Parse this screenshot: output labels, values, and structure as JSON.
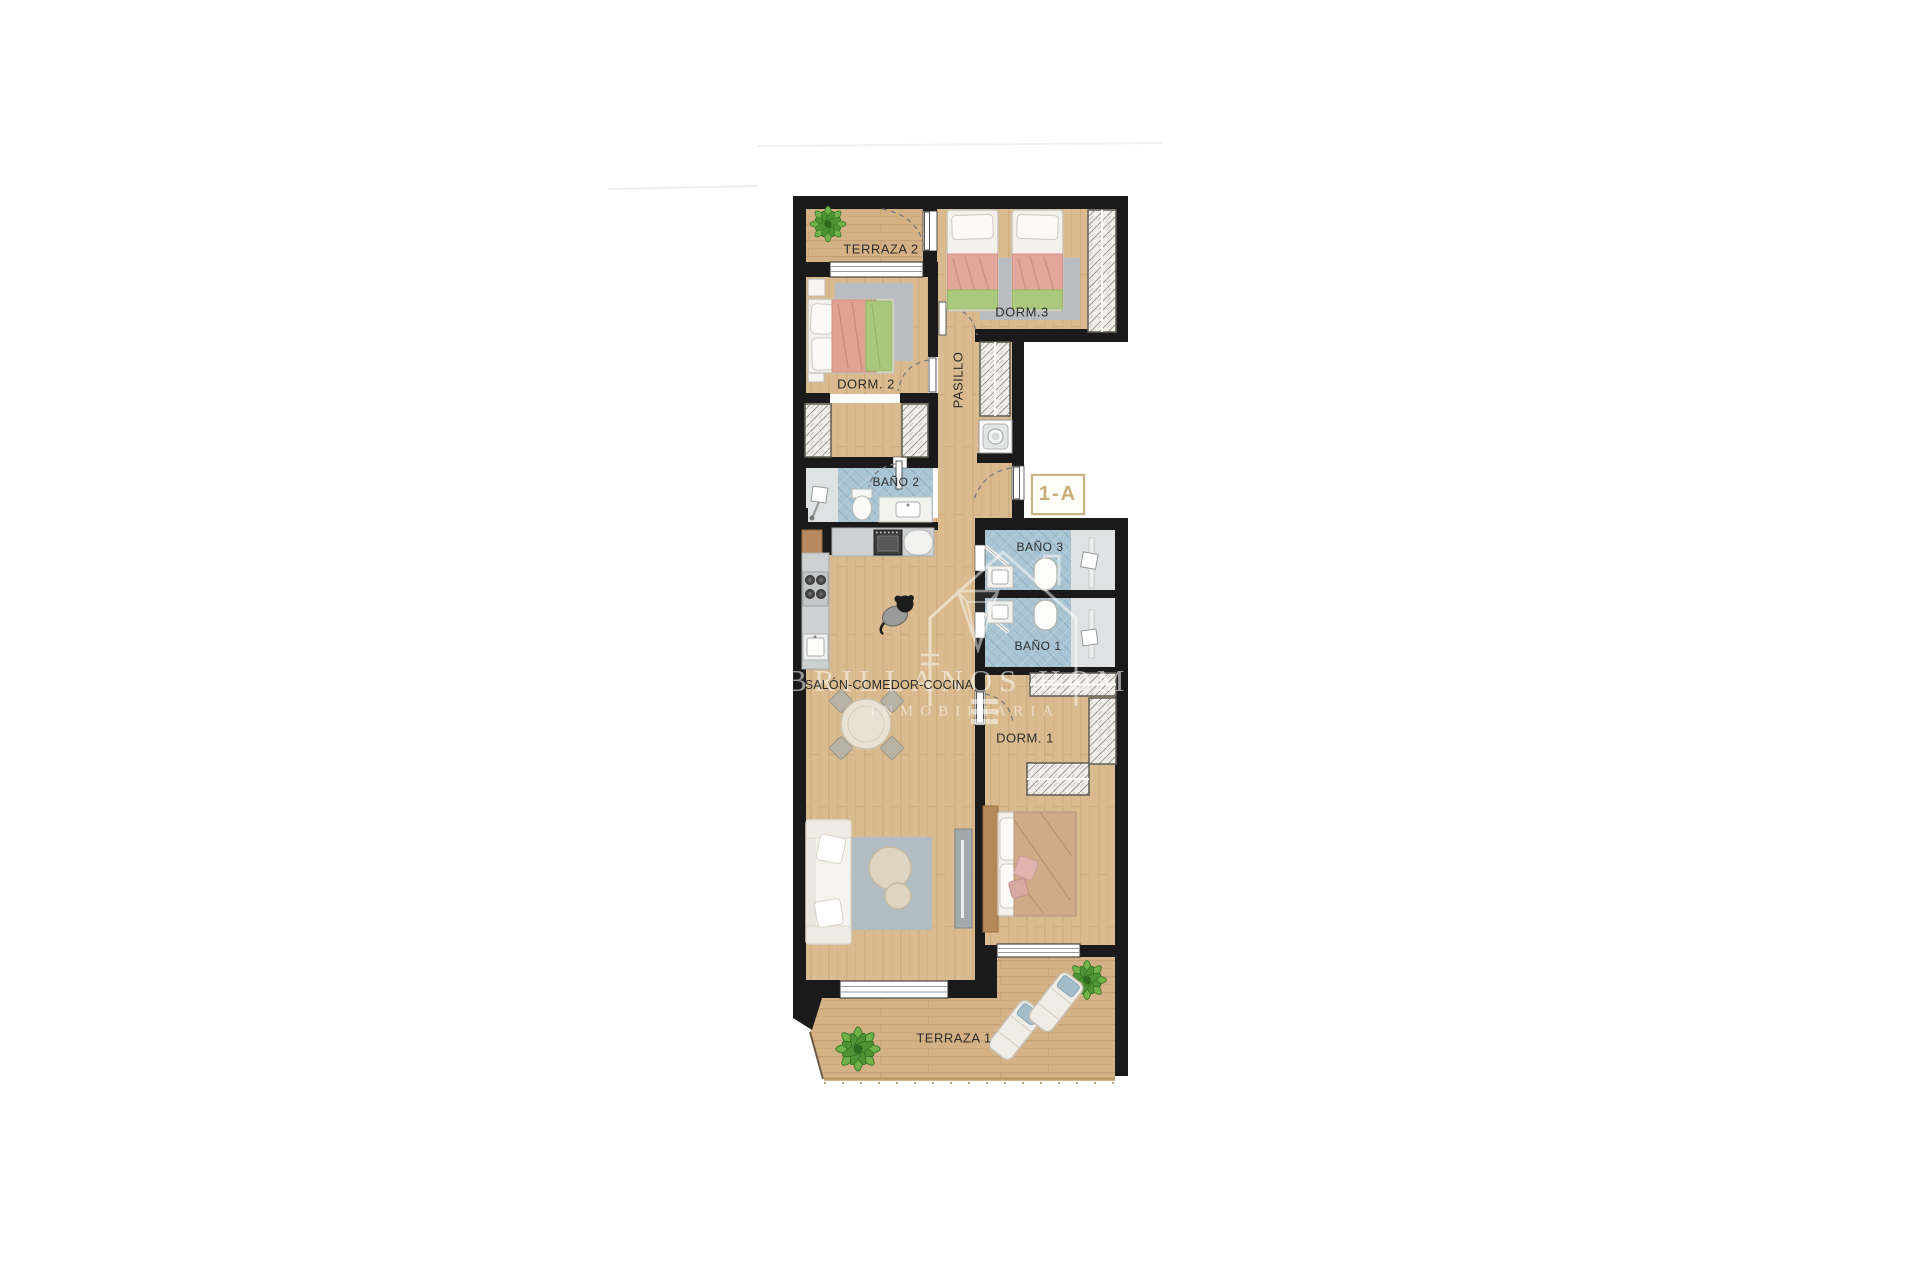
{
  "plan": {
    "unit_badge": "1-A",
    "rooms": {
      "terraza2": "TERRAZA 2",
      "dorm3": "DORM.3",
      "dorm2": "DORM. 2",
      "pasillo": "PASILLO",
      "bano2": "BAÑO 2",
      "bano3": "BAÑO 3",
      "bano1": "BAÑO 1",
      "salon": "SALÓN-COMEDOR-COCINA",
      "dorm1": "DORM. 1",
      "terraza1": "TERRAZA 1"
    },
    "watermark": {
      "brand": "BRILLANOS HOMES",
      "subtitle": "INMOBILIARIA"
    },
    "colors": {
      "wall": "#1a1a1a",
      "wood_floor": "#dabb8f",
      "terrace_wood": "#d3b083",
      "bathroom_tile": "#a9c4d3",
      "badge_gold": "#c5ae78"
    },
    "furniture_icons": [
      "plant-icon",
      "single-bed-icon",
      "double-bed-icon",
      "wardrobe-icon",
      "washing-machine-icon",
      "toilet-icon",
      "sink-icon",
      "bathtub-icon",
      "shower-icon",
      "stove-icon",
      "oven-icon",
      "dining-table-icon",
      "sofa-icon",
      "rug",
      "tv-unit-icon",
      "sun-lounger-icon",
      "dog-icon"
    ]
  }
}
